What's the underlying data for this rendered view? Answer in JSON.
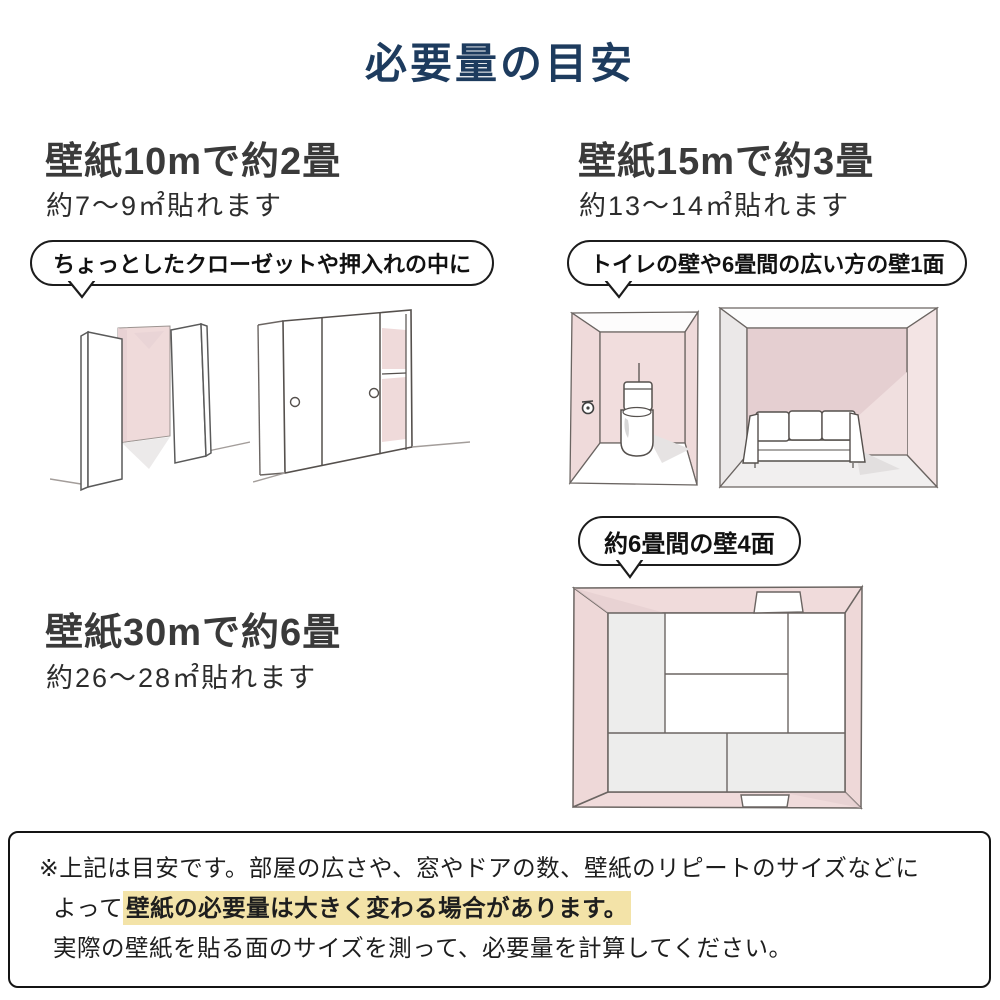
{
  "title": "必要量の目安",
  "colors": {
    "title_navy": "#1d3b5e",
    "heading_dark": "#3a3a3a",
    "wall_pink": "#f0dbdb",
    "wall_pink_dark": "#e5cfd1",
    "shadow_grey": "#ececec",
    "highlight_yellow": "#f3e3a8",
    "sketch_line": "#6b6562"
  },
  "sections": [
    {
      "heading": "壁紙10mで約2畳",
      "subheading": "約7〜9㎡貼れます",
      "bubble": "ちょっとしたクローゼットや押入れの中に",
      "illustrations": [
        "closet-open-doors-sketch",
        "closet-sliding-doors-sketch"
      ]
    },
    {
      "heading": "壁紙15mで約3畳",
      "subheading": "約13〜14㎡貼れます",
      "bubble": "トイレの壁や6畳間の広い方の壁1面",
      "illustrations": [
        "toilet-room-sketch",
        "living-room-sketch"
      ]
    },
    {
      "heading": "壁紙30mで約6畳",
      "subheading": "約26〜28㎡貼れます",
      "bubble": "約6畳間の壁4面",
      "illustrations": [
        "six-tatami-room-sketch"
      ]
    }
  ],
  "note": {
    "line1": "※上記は目安です。部屋の広さや、窓やドアの数、壁紙のリピートのサイズなどに",
    "line2_prefix": "よって",
    "line2_highlight": "壁紙の必要量は大きく変わる場合があります。",
    "line3": "実際の壁紙を貼る面のサイズを測って、必要量を計算してください。"
  }
}
